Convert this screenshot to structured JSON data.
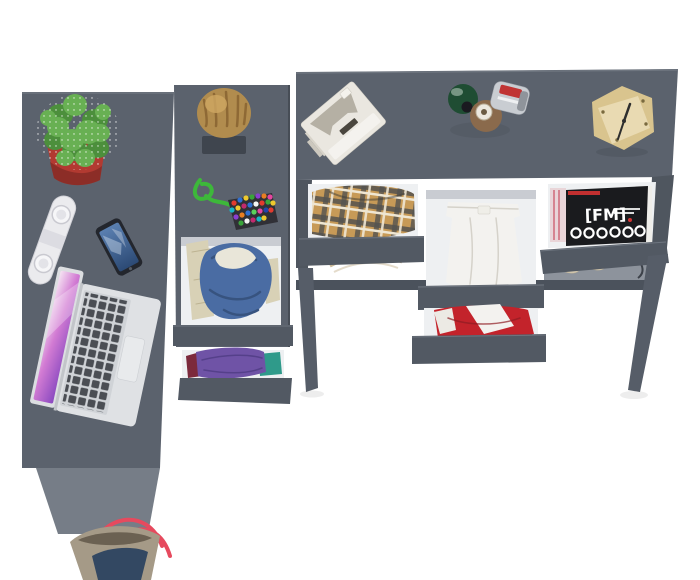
{
  "scene": {
    "description": "Top-down product render of a dark gray L-shaped desk and drawer set with open drawers, clothes and desk accessories on a white background",
    "background_color": "#ffffff"
  },
  "colors": {
    "surface": "#5b626d",
    "surface_edge": "#6e757f",
    "surface_dark": "#4f565f",
    "drawer_front": "#525963",
    "front_shadow": "#3f454e",
    "side_panel": "#767d87",
    "drawer_interior": "#eef0f2",
    "interior_shadow": "#c9ccd2",
    "leg": "#565d68",
    "shelf_band": "#8d939c",
    "crossbar": "#4b525c",
    "cactus_green": "#68b053",
    "cactus_green_dark": "#4c8f3c",
    "pot_red": "#b23a31",
    "pot_red_dark": "#8c2d27",
    "wood_log": "#b18c4e",
    "wood_log_dark": "#86602f",
    "log_bracket": "#3f454e",
    "clock_wood": "#e9dab2",
    "clock_wood_side": "#d9c48e",
    "speaker_white": "#ebebee",
    "phone_body": "#23262d",
    "laptop_body": "#dfe1e4",
    "laptop_keys": "#4b4e54",
    "denim_blue": "#4a6ca3",
    "denim_blue_dark": "#37537f",
    "cream_cloth": "#e9e6d9",
    "beige_cloth": "#d8d1b6",
    "purple_cloth": "#6f53a6",
    "teal_cloth": "#2f9a8a",
    "maroon_cloth": "#7c2a3c",
    "red_cloth": "#c3232b",
    "white_cloth": "#f3f2ef",
    "plaid_base": "#c79a57",
    "bag_body": "#a59a87",
    "bag_navy": "#334862",
    "bag_strap": "#e64a5e",
    "perfume_green": "#1f4d33",
    "perfume_amber": "#8a6a4c",
    "perfume_silver": "#c9cdd2",
    "perfume_red_label": "#c03434",
    "magazine_black": "#1a1b1e",
    "shoe_beige": "#d9cdb4",
    "cord_green": "#3db83a",
    "hanger_beige": "#c9b896",
    "typewriter_white": "#eae7e0",
    "typewriter_inset": "#b5b0a4"
  },
  "objects": {
    "magazine": {
      "title": "[FM]"
    },
    "bead_charm": {
      "dots": [
        [
          234,
          203,
          "#e23b2e"
        ],
        [
          240,
          200,
          "#2f6fd2"
        ],
        [
          246,
          198,
          "#eec92e"
        ],
        [
          252,
          197,
          "#3aa53a"
        ],
        [
          258,
          196,
          "#8a3fd0"
        ],
        [
          264,
          196,
          "#e87e22"
        ],
        [
          270,
          197,
          "#e645a0"
        ],
        [
          232,
          210,
          "#17b6c6"
        ],
        [
          238,
          208,
          "#eec92e"
        ],
        [
          244,
          206,
          "#c22a6e"
        ],
        [
          250,
          205,
          "#2f6fd2"
        ],
        [
          256,
          204,
          "#f5f5f5"
        ],
        [
          262,
          203,
          "#e23b2e"
        ],
        [
          268,
          202,
          "#3aa53a"
        ],
        [
          273,
          203,
          "#eec92e"
        ],
        [
          236,
          217,
          "#8a3fd0"
        ],
        [
          242,
          215,
          "#e87e22"
        ],
        [
          248,
          213,
          "#2f6fd2"
        ],
        [
          254,
          212,
          "#5bd05b"
        ],
        [
          260,
          211,
          "#e645a0"
        ],
        [
          266,
          210,
          "#2244aa"
        ],
        [
          271,
          210,
          "#e23b2e"
        ],
        [
          241,
          223,
          "#3aa53a"
        ],
        [
          247,
          221,
          "#f5f5f5"
        ],
        [
          253,
          220,
          "#c22a6e"
        ],
        [
          259,
          219,
          "#17b6c6"
        ],
        [
          264,
          218,
          "#eec92e"
        ]
      ]
    },
    "inventory": [
      {
        "id": "left-desk",
        "label": "dark gray desk top (left)"
      },
      {
        "id": "cactus-plant",
        "label": "cactus in red pot"
      },
      {
        "id": "portable-speaker",
        "label": "white portable speaker"
      },
      {
        "id": "smartphone",
        "label": "smartphone"
      },
      {
        "id": "laptop",
        "label": "open white laptop"
      },
      {
        "id": "tote-bag",
        "label": "tote bag with red straps"
      },
      {
        "id": "middle-cabinet",
        "label": "drawer cabinet (middle)"
      },
      {
        "id": "wood-log",
        "label": "decorative wood log on shelf"
      },
      {
        "id": "bead-charm",
        "label": "bead charm with green cord"
      },
      {
        "id": "drawer-denim",
        "label": "open drawer with denim jacket"
      },
      {
        "id": "drawer-clothes",
        "label": "open drawer with folded clothes"
      },
      {
        "id": "right-console",
        "label": "console desk with drawers (right)"
      },
      {
        "id": "typewriter",
        "label": "white retro typewriter"
      },
      {
        "id": "perfume-bottles",
        "label": "three perfume bottles"
      },
      {
        "id": "cube-clock",
        "label": "wooden cube clock"
      },
      {
        "id": "drawer-plaid",
        "label": "open drawer with plaid shirt"
      },
      {
        "id": "drawer-trousers",
        "label": "open drawer with white trousers"
      },
      {
        "id": "drawer-magazines",
        "label": "open drawer with magazines"
      },
      {
        "id": "drawer-red",
        "label": "open drawer with red clothes"
      },
      {
        "id": "shoes",
        "label": "pair of beige shoes on lower shelf"
      },
      {
        "id": "clothes-hanger",
        "label": "wooden clothes hanger"
      }
    ]
  }
}
